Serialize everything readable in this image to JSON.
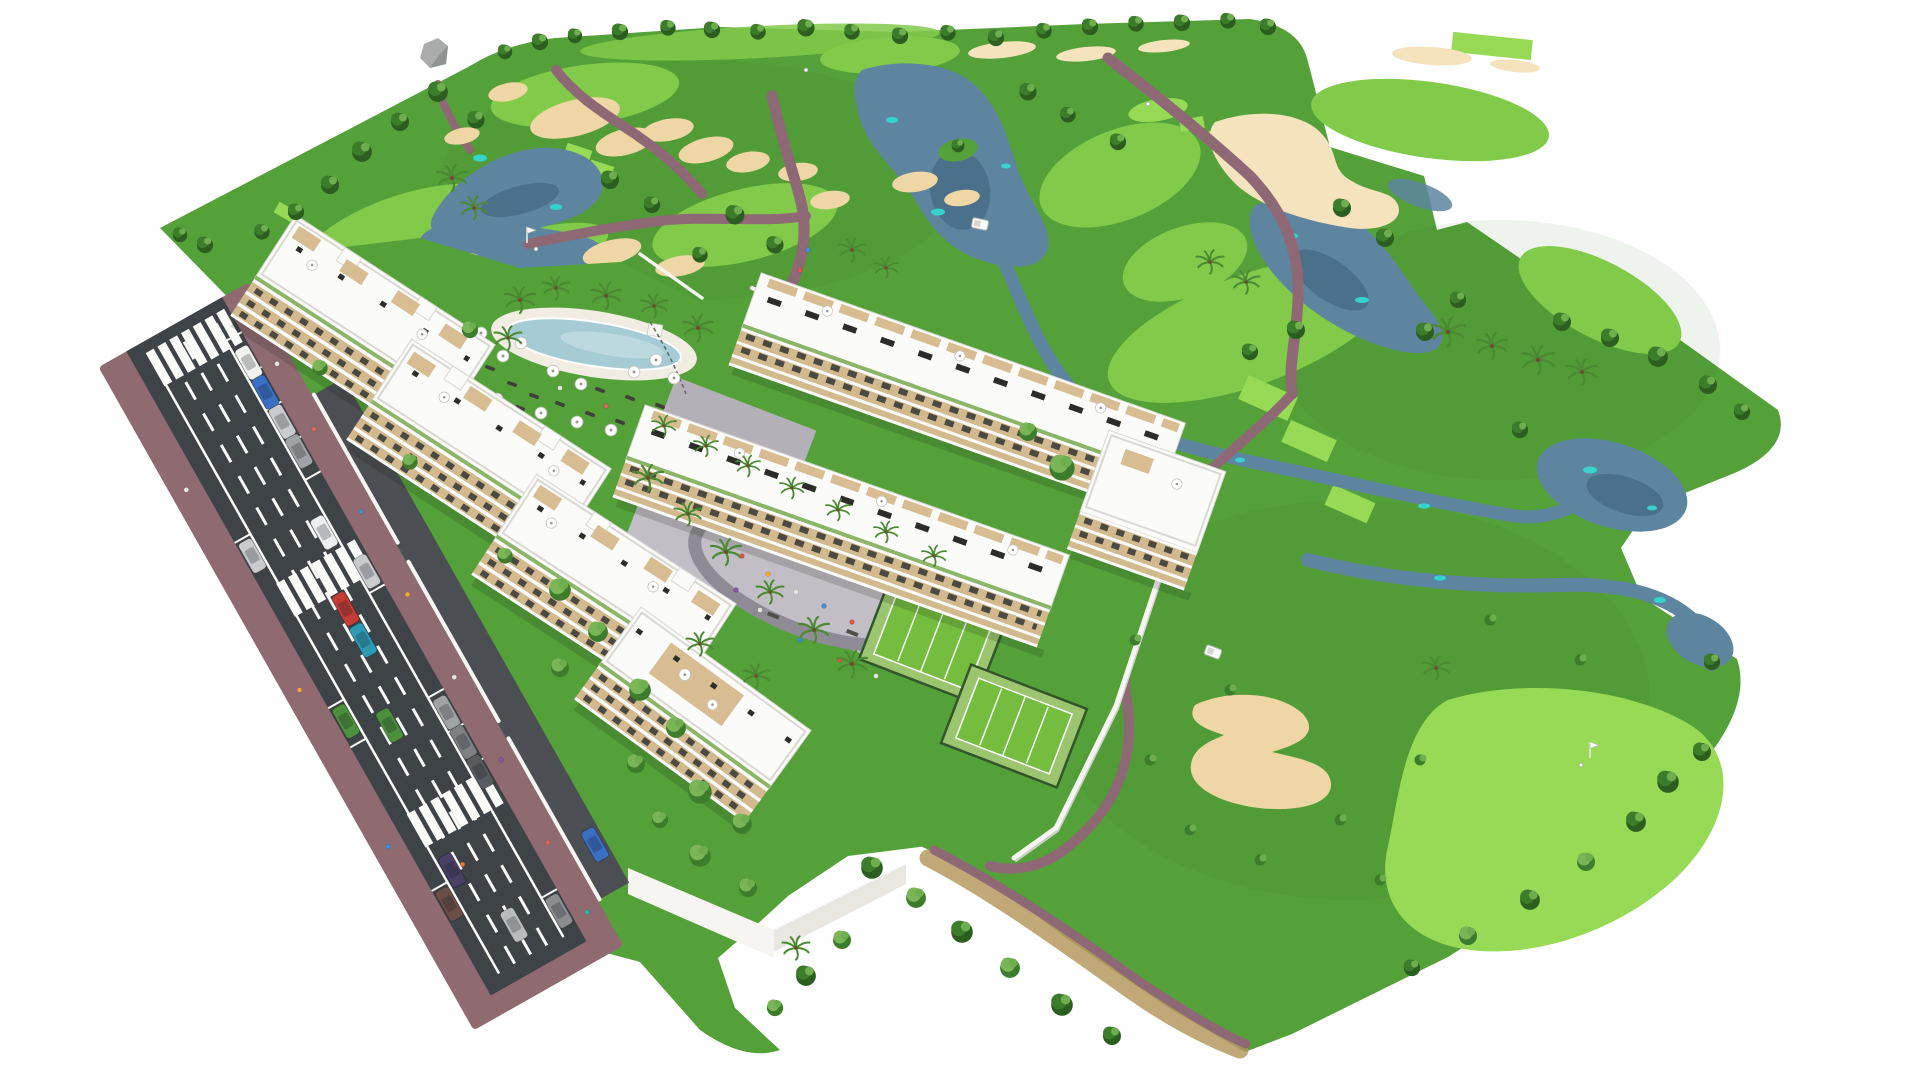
{
  "meta": {
    "kind": "3d-aerial-architectural-render",
    "width_px": 1920,
    "height_px": 1079,
    "background": "white",
    "description": "Aerial isometric render of a white Mediterranean apartment complex beside a golf course: diagonal avenue with parked cars and crosswalks at lower left, four stepped apartment blocks and two townhouse rows with rooftop terraces, lagoon pool with parasols, grey playground plaza, two padel courts, walled gardens, and a rolling golf course with fairways, bright greens, tee boxes, sand bunkers, grey-blue lakes, streams, mauve cart paths, palm and broadleaf trees on a white cut-out background."
  },
  "scene": {
    "inventory": {
      "apartment_blocks": 4,
      "townhouse_rows": 2,
      "end_tower_blocks": 1,
      "swimming_pools": 1,
      "pool_parasols": 12,
      "padel_courts": 2,
      "playground_plazas": 1,
      "golf_putting_greens": 3,
      "golf_tee_boxes": 9,
      "golf_flags": 2,
      "golf_carts": 2,
      "lakes": 4,
      "streams": 2,
      "sand_bunkers": 19,
      "crosswalks": 3,
      "parked_cars": 12,
      "moving_cars": 7,
      "perimeter_walls": true,
      "people": "small figures on plaza, sidewalks and pool lawn"
    }
  },
  "palette": {
    "bg": "#ffffff",
    "grass": "#54a139",
    "grass_shade": "#2f6b22",
    "fairway": "#82ca4a",
    "green_bright": "#97da55",
    "water": "#5d85a0",
    "water_dark": "#3c5f78",
    "water_teal": "#35d3cc",
    "sand": "#eed7a4",
    "sand_light": "#f4e3bd",
    "path": "#8f6876",
    "scrub": "#b6995f",
    "road": "#3e4347",
    "sidewalk": "#8f6a70",
    "drive": "#4b4e52",
    "marking": "#fafaf8",
    "plaza": "#c2bec6",
    "plaza_dark": "#b4b0b8",
    "plaza_ring": "#8f8b94",
    "equipment": "#4f4f4a",
    "wall": "#f6f5f1",
    "wall_shade": "#e9e7e1",
    "wall_shadow": "#cfcec8",
    "building_white": "#fbfbf9",
    "building_edge": "#d9d8d2",
    "building_face": "#d3b98e",
    "opening": "#4b4a42",
    "wood": "#c9a87c",
    "wood_light": "#d9bd92",
    "panel": "#2c2c28",
    "roof_green": "#7fae57",
    "court_green": "#74bd3f",
    "court_light": "#9cc56f",
    "fence": "#33552c",
    "pool": "#a5cbd4",
    "pool_light": "#bcd9df",
    "pool_deck": "#f1ede2",
    "tree_dark": "#2c5e1f",
    "tree": "#3c7d2b",
    "tree_light": "#6fae4e",
    "tree_bright": "#7ab558",
    "palm": "#4b8a33",
    "rock": "#a8adab",
    "rock_dark": "#8e9492",
    "shadow_col": "#1e2819",
    "car_white": "#f2f2ef",
    "car_silver": "#c9cbcd",
    "car_gray": "#9fa3a6",
    "car_dark": "#585c60",
    "car_red": "#c23b35",
    "car_teal": "#2e9bb5",
    "car_blue": "#3a6fc4",
    "car_green": "#4c8f3c",
    "car_purple": "#4a3f66",
    "car_brown": "#6b4f46",
    "person_red": "#e05347",
    "person_orange": "#f2a93b",
    "person_blue": "#3f8fd2",
    "person_teal": "#37b3aa",
    "person_purple": "#8455a0",
    "person_white": "#e8e6e0"
  }
}
